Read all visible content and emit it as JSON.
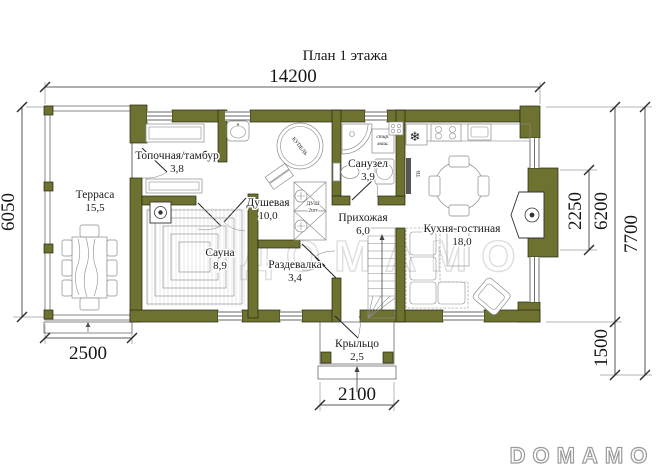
{
  "meta": {
    "title": "План 1 этажа"
  },
  "watermarks": {
    "center": "ДОМАМО",
    "logo": "DOMAMO"
  },
  "colors": {
    "wall": "#6e7231",
    "dimension": "#1c1c1c",
    "furniture": "#8b8b8b",
    "watermark": "#dedede"
  },
  "dims": {
    "total_width": "14200",
    "terrace_depth": "6050",
    "terrace_width": "2500",
    "porch_width": "2100",
    "bay_height": "2250",
    "house_depth": "6200",
    "porch_depth": "1500",
    "total_depth": "7700"
  },
  "rooms": {
    "terrace": {
      "name": "Терраса",
      "area": "15,5"
    },
    "boiler": {
      "name": "Топочная/тамбур",
      "area": "3,8"
    },
    "sauna": {
      "name": "Сауна",
      "area": "8,9"
    },
    "shower": {
      "name": "Душевая",
      "area": "10,0"
    },
    "dressing": {
      "name": "Раздевалка",
      "area": "3,4"
    },
    "bathroom": {
      "name": "Санузел",
      "area": "3,9"
    },
    "hall": {
      "name": "Прихожая",
      "area": "6,0"
    },
    "kitchen": {
      "name": "Кухня-гостиная",
      "area": "18,0"
    },
    "porch": {
      "name": "Крыльцо",
      "area": "2,5"
    }
  },
  "labels": {
    "tub": "КУПЕЛЬ",
    "shower_line1": "ДУШ",
    "shower_line2": "2шт",
    "washer_line1": "стир.",
    "washer_line2": "маш.",
    "tv": "ТВ",
    "snowflake": "❄"
  }
}
